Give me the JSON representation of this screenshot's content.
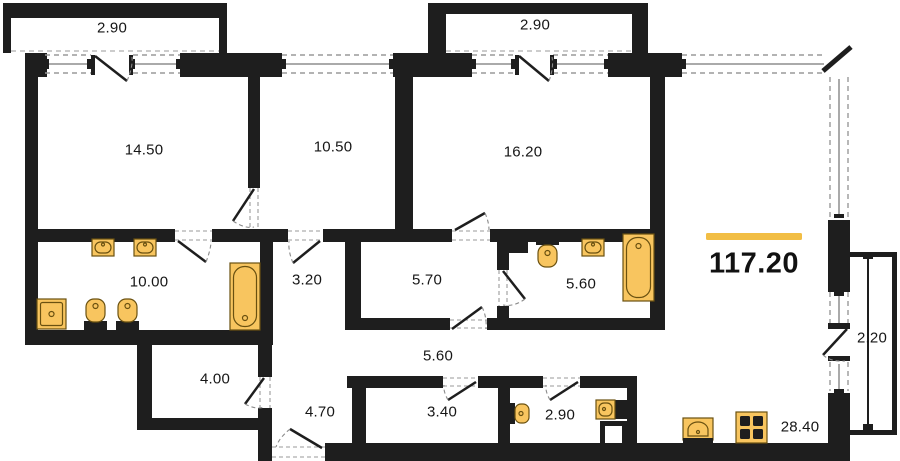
{
  "plan": {
    "type": "apartment-floor-plan",
    "total_area": "117.20",
    "rooms": [
      {
        "id": "balcony-top-left",
        "label": "2.90"
      },
      {
        "id": "balcony-top-right",
        "label": "2.90"
      },
      {
        "id": "room-14-50",
        "label": "14.50"
      },
      {
        "id": "room-10-50",
        "label": "10.50"
      },
      {
        "id": "room-16-20",
        "label": "16.20"
      },
      {
        "id": "bathroom-10-00",
        "label": "10.00"
      },
      {
        "id": "hall-3-20",
        "label": "3.20"
      },
      {
        "id": "room-5-70",
        "label": "5.70"
      },
      {
        "id": "bathroom-5-60",
        "label": "5.60"
      },
      {
        "id": "room-4-00",
        "label": "4.00"
      },
      {
        "id": "hall-4-70",
        "label": "4.70"
      },
      {
        "id": "corridor-5-60",
        "label": "5.60"
      },
      {
        "id": "room-3-40",
        "label": "3.40"
      },
      {
        "id": "wc-2-90",
        "label": "2.90"
      },
      {
        "id": "kitchen-living-28-40",
        "label": "28.40"
      },
      {
        "id": "balcony-right-2-20",
        "label": "2.20"
      }
    ],
    "colors": {
      "walls": "#1e1e1e",
      "fixture_fill": "#f8c55f",
      "fixture_outline": "#6a5110",
      "accent_bar": "#f2be45",
      "window_dash": "#9a9a9a"
    },
    "fixtures": [
      "sink-icon",
      "toilet-icon",
      "bidet-icon",
      "shower-icon",
      "bathtub-icon",
      "kitchen-sink-icon",
      "stove-icon"
    ]
  }
}
